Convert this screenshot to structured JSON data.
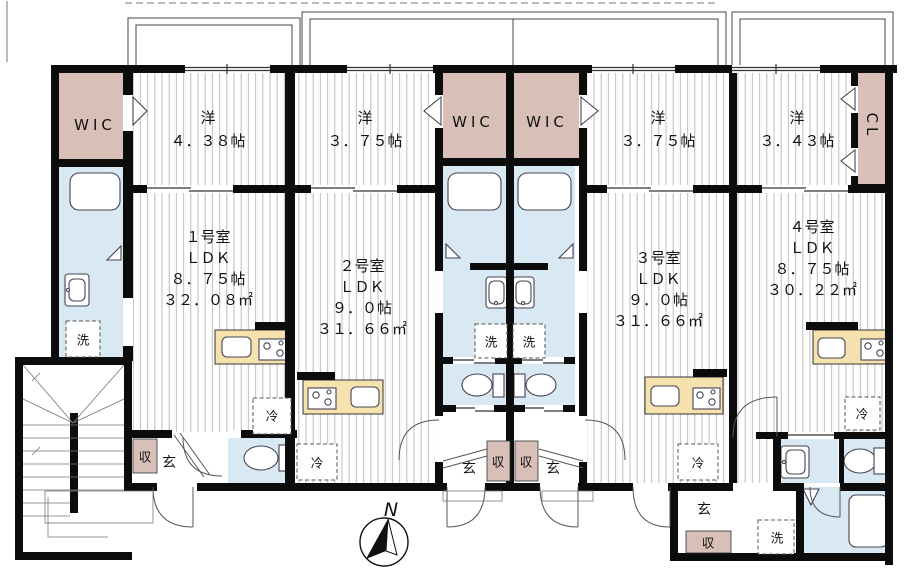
{
  "plan_type": "apartment-floor-plan",
  "colors": {
    "closet": "#d8bfb8",
    "wet": "#d9e9f4",
    "kitchen": "#f5e2ae",
    "wall": "#0c0c0c"
  },
  "labels": {
    "wic": "WIC",
    "cl": "CL",
    "wash": "洗",
    "fridge": "冷",
    "entrance": "玄",
    "storage": "収",
    "north": "N"
  },
  "units": [
    {
      "no": "１号室",
      "ldk": "ＬＤＫ",
      "jo": "８．７５帖",
      "area": "３２．０８㎡",
      "bed_label": "洋",
      "bed_size": "４．３８帖"
    },
    {
      "no": "２号室",
      "ldk": "ＬＤＫ",
      "jo": "９．０帖",
      "area": "３１．６６㎡",
      "bed_label": "洋",
      "bed_size": "３．７５帖"
    },
    {
      "no": "３号室",
      "ldk": "ＬＤＫ",
      "jo": "９．０帖",
      "area": "３１．６６㎡",
      "bed_label": "洋",
      "bed_size": "３．７５帖"
    },
    {
      "no": "４号室",
      "ldk": "ＬＤＫ",
      "jo": "８．７５帖",
      "area": "３０．２２㎡",
      "bed_label": "洋",
      "bed_size": "３．４３帖"
    }
  ]
}
